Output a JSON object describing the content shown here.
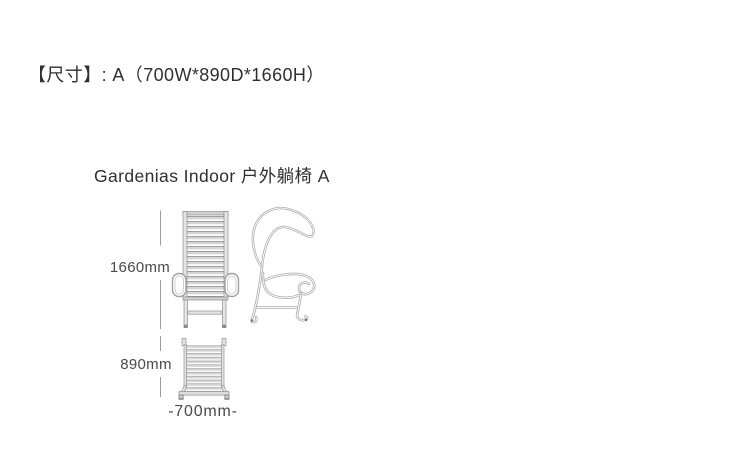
{
  "header": {
    "size_label": "【尺寸】: A（700W*890D*1660H）"
  },
  "product": {
    "title": "Gardenias Indoor 户外躺椅 A"
  },
  "dimensions": {
    "height": "1660mm",
    "depth": "890mm",
    "width": "-700mm-"
  },
  "colors": {
    "text_dark": "#303030",
    "text_dim": "#4a4a4a",
    "line_gray": "#ababab",
    "slat_fill": "#d5d5d5"
  }
}
